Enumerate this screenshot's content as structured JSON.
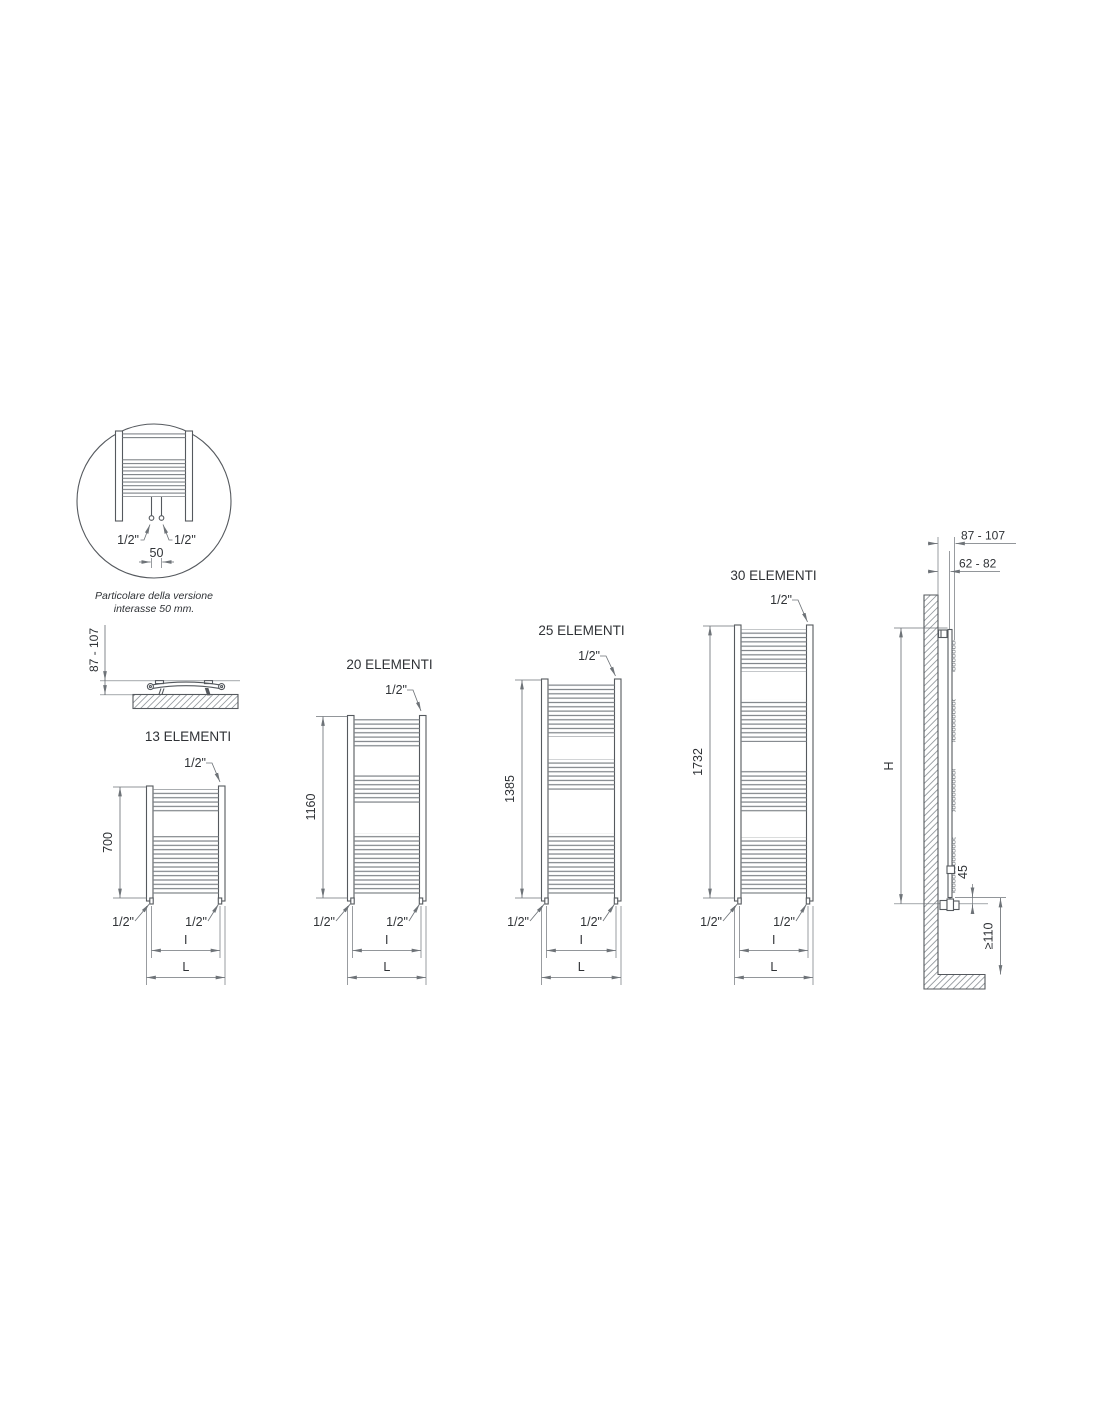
{
  "colors": {
    "background": "#ffffff",
    "line": "#55595e",
    "dimension": "#6e7378",
    "text": "#2f3236",
    "tube": "#7d8287",
    "hatch": "#90969b"
  },
  "detail_view": {
    "inlet_left": "1/2\"",
    "inlet_right": "1/2\"",
    "pipe_spacing": "50",
    "caption_line1": "Particolare della versione",
    "caption_line2": "interasse 50 mm."
  },
  "plan_view": {
    "wall_distance": "87 - 107"
  },
  "models": [
    {
      "title": "13 ELEMENTI",
      "height": "700",
      "inlet_top": "1/2\"",
      "inlet_bottom_left": "1/2\"",
      "inlet_bottom_right": "1/2\"",
      "interaxis": "I",
      "width": "L"
    },
    {
      "title": "20 ELEMENTI",
      "height": "1160",
      "inlet_top": "1/2\"",
      "inlet_bottom_left": "1/2\"",
      "inlet_bottom_right": "1/2\"",
      "interaxis": "I",
      "width": "L"
    },
    {
      "title": "25 ELEMENTI",
      "height": "1385",
      "inlet_top": "1/2\"",
      "inlet_bottom_left": "1/2\"",
      "inlet_bottom_right": "1/2\"",
      "interaxis": "I",
      "width": "L"
    },
    {
      "title": "30 ELEMENTI",
      "height": "1732",
      "inlet_top": "1/2\"",
      "inlet_bottom_left": "1/2\"",
      "inlet_bottom_right": "1/2\"",
      "interaxis": "I",
      "width": "L"
    }
  ],
  "side_view": {
    "wall_to_front": "87 - 107",
    "wall_to_axis": "62 - 82",
    "height_label": "H",
    "valve_offset": "45",
    "floor_clearance": "≥110"
  }
}
